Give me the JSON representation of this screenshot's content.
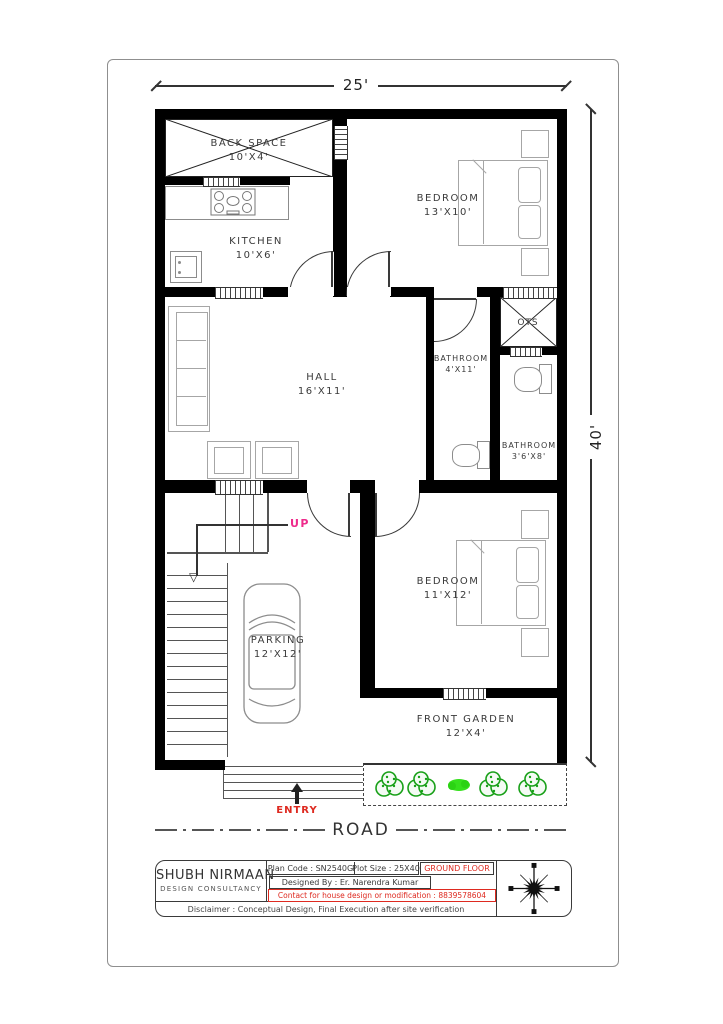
{
  "dimensions": {
    "width_label": "25'",
    "height_label": "40'"
  },
  "plan": {
    "rooms": [
      {
        "id": "back-space",
        "name": "BACK SPACE",
        "size": "10'X4'"
      },
      {
        "id": "bedroom-1",
        "name": "BEDROOM",
        "size": "13'X10'"
      },
      {
        "id": "kitchen",
        "name": "KITCHEN",
        "size": "10'X6'"
      },
      {
        "id": "hall",
        "name": "HALL",
        "size": "16'X11'"
      },
      {
        "id": "bathroom-1",
        "name": "BATHROOM",
        "size": "4'X11'"
      },
      {
        "id": "ots",
        "name": "OTS",
        "size": ""
      },
      {
        "id": "bathroom-2",
        "name": "BATHROOM",
        "size": "3'6'X8'"
      },
      {
        "id": "bedroom-2",
        "name": "BEDROOM",
        "size": "11'X12'"
      },
      {
        "id": "parking",
        "name": "PARKING",
        "size": "12'X12'"
      },
      {
        "id": "front-garden",
        "name": "FRONT GARDEN",
        "size": "12'X4'"
      }
    ],
    "annotations": {
      "up": "UP",
      "entry": "ENTRY",
      "road": "ROAD"
    }
  },
  "title_block": {
    "company_name": "SHUBH NIRMAAN",
    "company_subtitle": "DESIGN CONSULTANCY",
    "plan_code": "Plan Code : SN2540G",
    "plot_size": "Plot Size : 25X40",
    "floor": "GROUND FLOOR",
    "designed_by": "Designed By : Er. Narendra Kumar",
    "contact": "Contact for house design or modification : 8839578604",
    "disclaimer": "Disclaimer : Conceptual Design, Final Execution after site verification"
  },
  "colors": {
    "wall": "#000000",
    "furniture": "#a6a6a6",
    "up_magenta": "#ee2a8b",
    "entry_red": "#de2a20",
    "title_red": "#de2a20",
    "bush_green": "#18a018",
    "bright_green": "#35e01c"
  }
}
